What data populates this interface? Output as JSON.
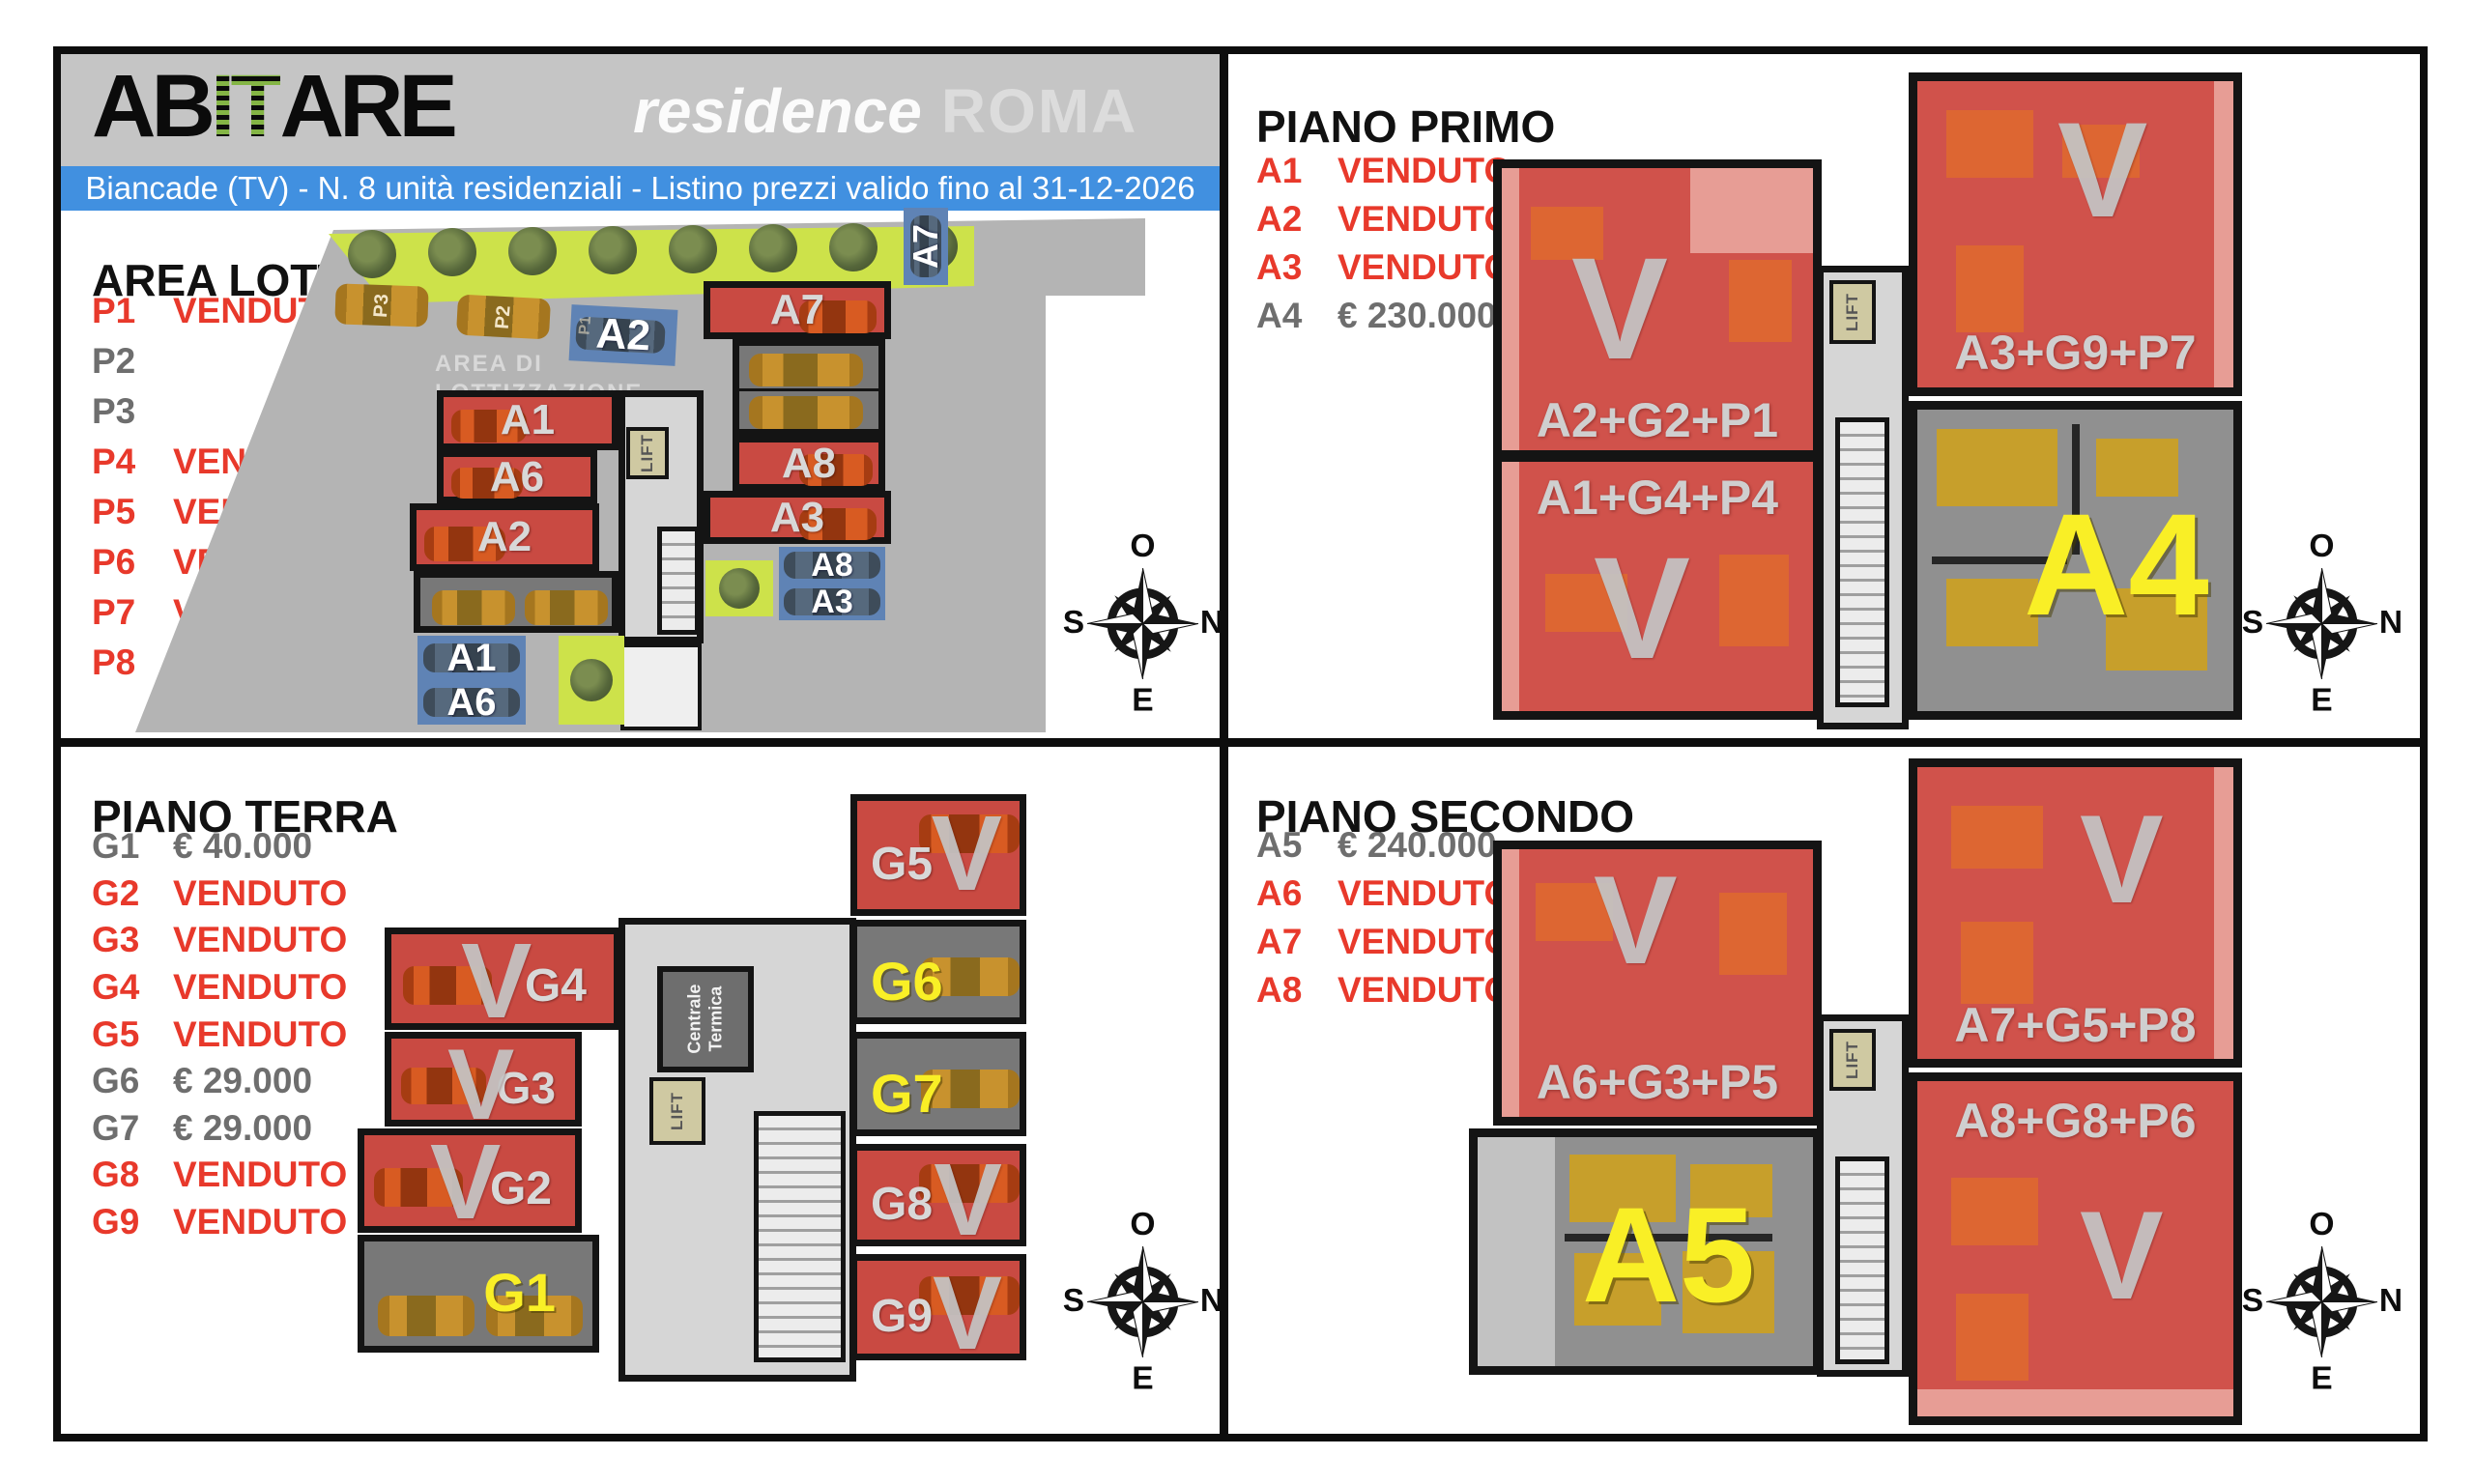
{
  "header": {
    "logo_ab": "AB",
    "logo_it": "IT",
    "logo_are": "ARE",
    "residence": "residence",
    "city": "ROMA",
    "banner": "Biancade (TV) - N. 8 unità residenziali  - Listino prezzi valido fino al 31-12-2026"
  },
  "compass": {
    "top": "O",
    "right": "N",
    "left": "S",
    "bottom": "E"
  },
  "area_lotto": {
    "title": "AREA LOTTO",
    "items": [
      {
        "code": "P1",
        "status": "VENDUTO",
        "sold": true
      },
      {
        "code": "P2",
        "status": "",
        "sold": false
      },
      {
        "code": "P3",
        "status": "",
        "sold": false
      },
      {
        "code": "P4",
        "status": "VENDUTO",
        "sold": true
      },
      {
        "code": "P5",
        "status": "VENDUTO",
        "sold": true
      },
      {
        "code": "P6",
        "status": "VENDUTO",
        "sold": true
      },
      {
        "code": "P7",
        "status": "VENDUTO",
        "sold": true
      },
      {
        "code": "P8",
        "status": "VENDUTO",
        "sold": true
      }
    ],
    "plan": {
      "area_label_1": "AREA DI",
      "area_label_2": "LOTTIZZAZIONE",
      "car_p3": "P3",
      "car_p2": "P2",
      "car_p1": "P1",
      "spot_a2": "A2",
      "spot_a7": "A7",
      "block_a1": "A1",
      "block_a6": "A6",
      "block_a2": "A2",
      "block_a7": "A7",
      "block_a8": "A8",
      "block_a3": "A3",
      "park_a1": "A1",
      "park_a6": "A6",
      "park_a8": "A8",
      "park_a3": "A3",
      "lift": "LIFT"
    }
  },
  "piano_primo": {
    "title": "PIANO PRIMO",
    "items": [
      {
        "code": "A1",
        "status": "VENDUTO",
        "sold": true
      },
      {
        "code": "A2",
        "status": "VENDUTO",
        "sold": true
      },
      {
        "code": "A3",
        "status": "VENDUTO",
        "sold": true
      },
      {
        "code": "A4",
        "status": "€ 230.000",
        "sold": false
      }
    ],
    "plan": {
      "sold_mark": "V",
      "left_upper": "A2+G2+P1",
      "left_lower": "A1+G4+P4",
      "right_upper": "A3+G9+P7",
      "available_unit": "A4",
      "lift": "LIFT"
    }
  },
  "piano_terra": {
    "title": "PIANO TERRA",
    "items": [
      {
        "code": "G1",
        "status": "€ 40.000",
        "sold": false
      },
      {
        "code": "G2",
        "status": "VENDUTO",
        "sold": true
      },
      {
        "code": "G3",
        "status": "VENDUTO",
        "sold": true
      },
      {
        "code": "G4",
        "status": "VENDUTO",
        "sold": true
      },
      {
        "code": "G5",
        "status": "VENDUTO",
        "sold": true
      },
      {
        "code": "G6",
        "status": "€ 29.000",
        "sold": false
      },
      {
        "code": "G7",
        "status": "€ 29.000",
        "sold": false
      },
      {
        "code": "G8",
        "status": "VENDUTO",
        "sold": true
      },
      {
        "code": "G9",
        "status": "VENDUTO",
        "sold": true
      }
    ],
    "plan": {
      "sold_mark": "V",
      "g1": "G1",
      "g2": "G2",
      "g3": "G3",
      "g4": "G4",
      "g5": "G5",
      "g6": "G6",
      "g7": "G7",
      "g8": "G8",
      "g9": "G9",
      "centrale_1": "Centrale",
      "centrale_2": "Termica",
      "lift": "LIFT"
    }
  },
  "piano_secondo": {
    "title": "PIANO SECONDO",
    "items": [
      {
        "code": "A5",
        "status": "€ 240.000",
        "sold": false
      },
      {
        "code": "A6",
        "status": "VENDUTO",
        "sold": true
      },
      {
        "code": "A7",
        "status": "VENDUTO",
        "sold": true
      },
      {
        "code": "A8",
        "status": "VENDUTO",
        "sold": true
      }
    ],
    "plan": {
      "sold_mark": "V",
      "left_upper": "A6+G3+P5",
      "right_upper": "A7+G5+P8",
      "right_lower": "A8+G8+P6",
      "available_unit": "A5",
      "lift": "LIFT"
    }
  },
  "colors": {
    "sold_red": "#e8392b",
    "price_gray": "#6e6e6e",
    "banner_blue": "#4190e0",
    "highlight_yellow": "#f9ef26",
    "plan_red": "#c94a42",
    "apartment_red": "#d0524b",
    "parking_blue": "#5f83b5",
    "header_gray": "#c5c5c5",
    "logo_green": "#84b545"
  }
}
